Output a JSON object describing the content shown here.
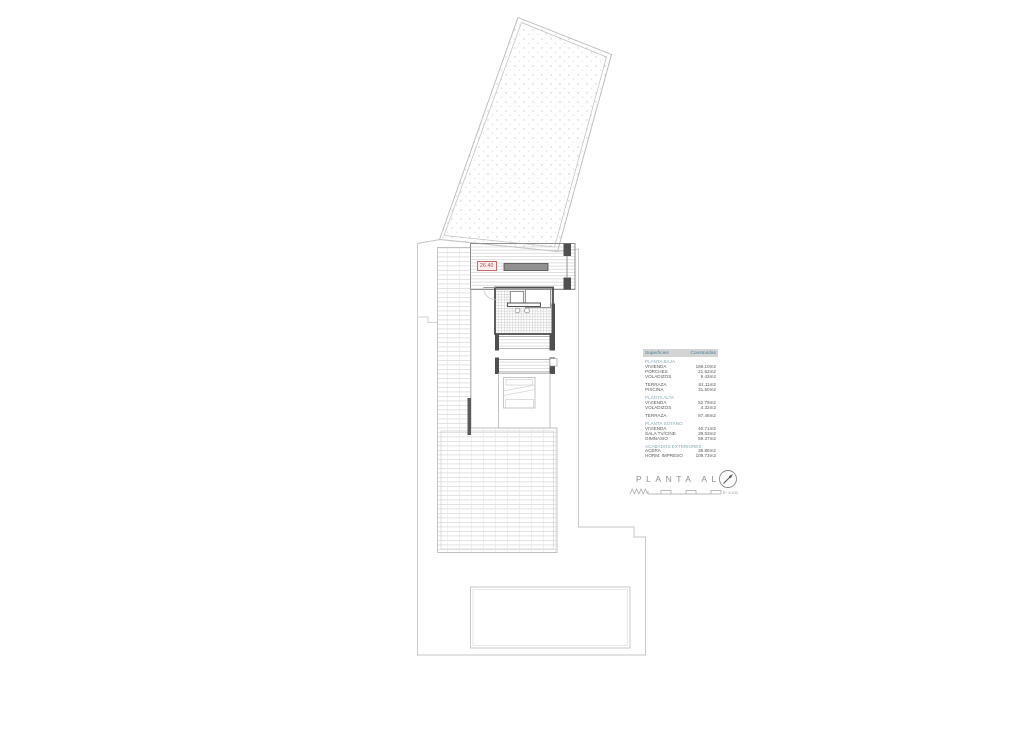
{
  "plan": {
    "level_badge": "26.40",
    "colors": {
      "wall_dark": "#4f4f4f",
      "line_light": "#c5c5c5",
      "badge_red": "#c23b3b",
      "accent_teal": "#4e8298",
      "table_header_bg": "#d4d4d4"
    },
    "icons": {
      "north": "north-arrow-icon",
      "scale": "scale-bar"
    }
  },
  "area_table": {
    "header": {
      "col1": "Superficies",
      "col2": "Construidas"
    },
    "rows": [
      {
        "label": "PLANTA BAJA",
        "value": ""
      },
      {
        "label": "VIVIENDA",
        "value": "169.10m2"
      },
      {
        "label": "PORCHES",
        "value": "21.62m2"
      },
      {
        "label": "VOLADIZOS",
        "value": "9.43m2"
      },
      {
        "label": "TERRAZA",
        "value": "81.11m2"
      },
      {
        "label": "PISCINA",
        "value": "31.50m2"
      },
      {
        "label": "PLANTA ALTA",
        "value": ""
      },
      {
        "label": "VIVIENDA",
        "value": "52.79m2"
      },
      {
        "label": "VOLADIZOS",
        "value": "4.32m2"
      },
      {
        "label": "TERRAZA",
        "value": "87.46m2"
      },
      {
        "label": "PLANTA SOTANO",
        "value": ""
      },
      {
        "label": "VIVIENDA",
        "value": "40.71m2"
      },
      {
        "label": "SALA TV/CINE",
        "value": "39.53m2"
      },
      {
        "label": "GIMNASIO",
        "value": "59.37m2"
      },
      {
        "label": "ACABADOS EXTERIORES",
        "value": ""
      },
      {
        "label": "ACERA",
        "value": "36.86m2"
      },
      {
        "label": "HORM. IMPRESO",
        "value": "109.73m2"
      }
    ]
  },
  "title_block": {
    "title": "PLANTA ALTA",
    "scale_label": "E: 1/100"
  }
}
